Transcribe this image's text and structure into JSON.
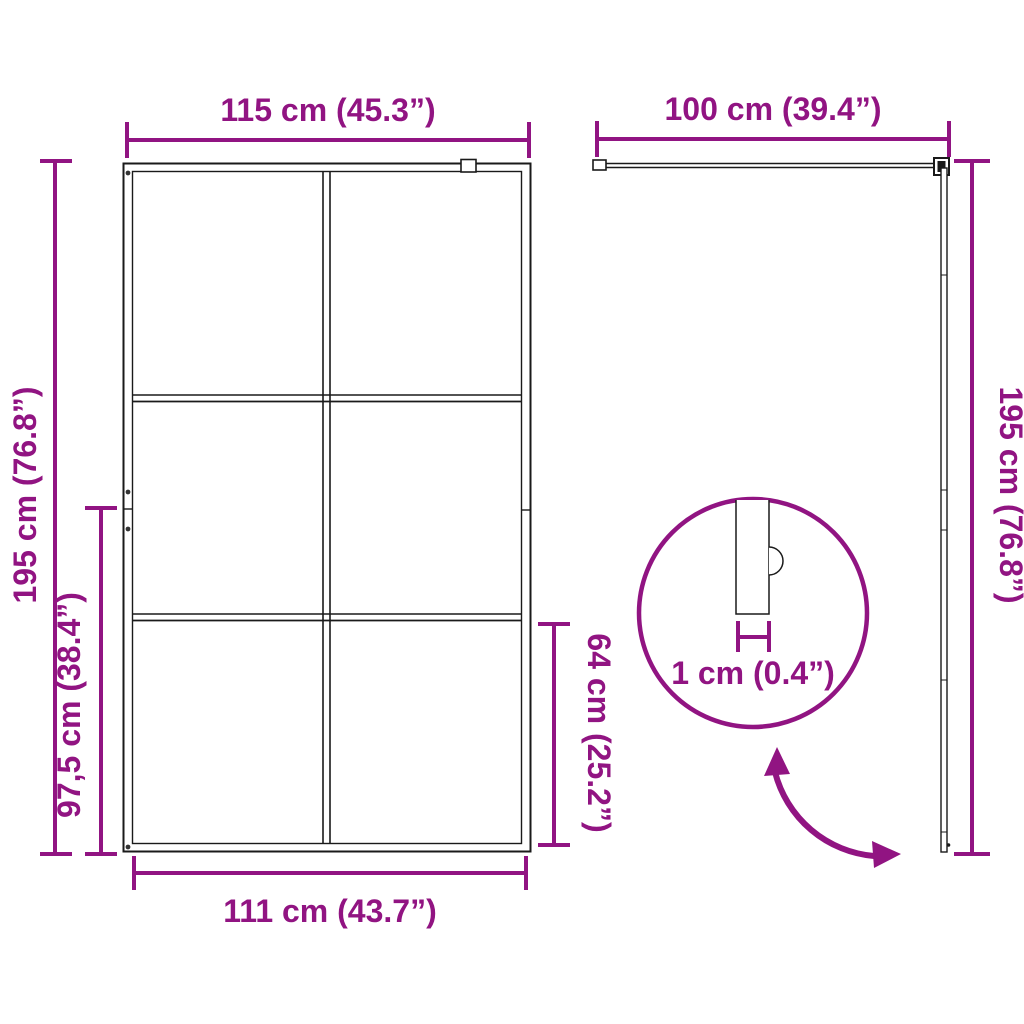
{
  "colors": {
    "accent": "#911482",
    "line": "#1a1a1a",
    "background": "#ffffff"
  },
  "front_view": {
    "label": "front-view-of-glass-shower-screen",
    "dim_width_top": "115 cm (45.3”)",
    "dim_height_left": "195 cm (76.8”)",
    "dim_height_partial_left": "97,5 cm (38.4”)",
    "dim_height_partial_right": "64 cm (25.2”)",
    "dim_width_bottom": "111 cm (43.7”)",
    "panel_columns": 2,
    "panel_rows": 3
  },
  "side_view": {
    "label": "side-profile-with-support-arm",
    "dim_arm_length_top": "100 cm (39.4”)",
    "dim_height_right": "195 cm (76.8”)"
  },
  "detail_view": {
    "label": "glass-thickness-detail",
    "dim_glass_thickness": "1 cm (0.4”)"
  }
}
